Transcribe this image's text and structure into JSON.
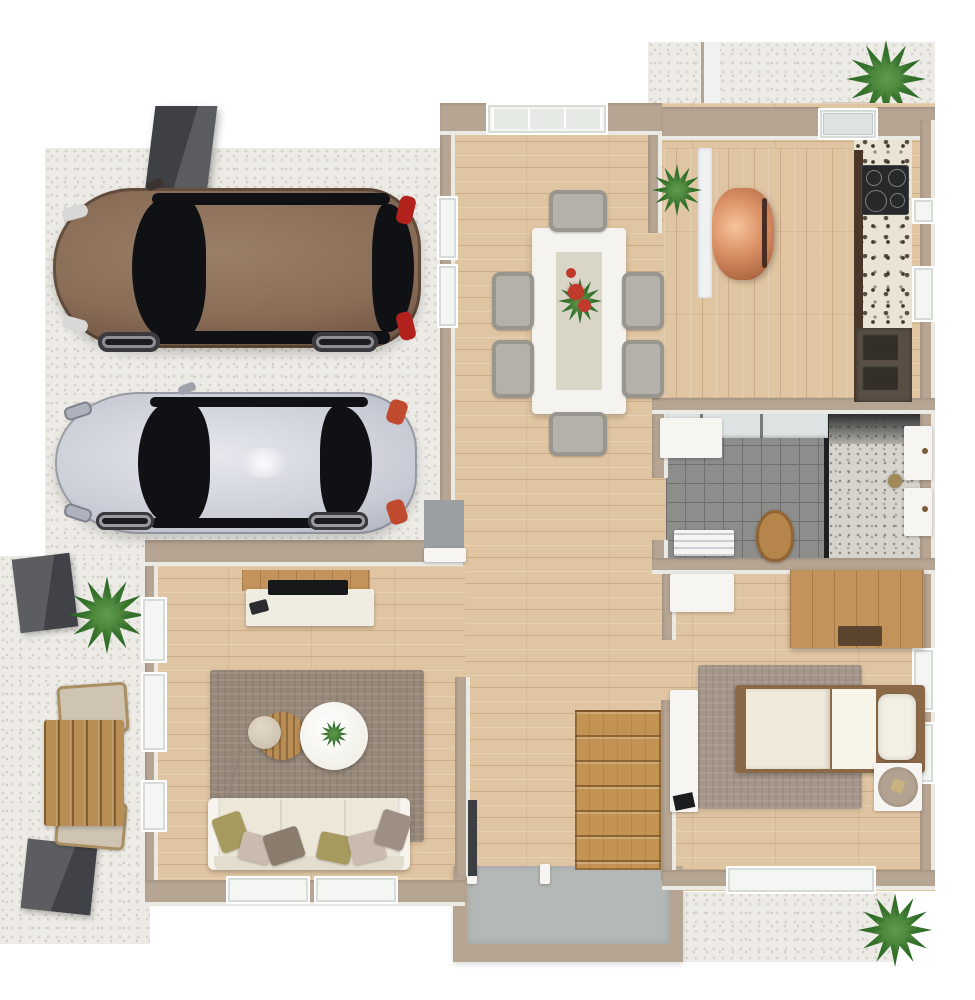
{
  "scene": {
    "description": "3D rendered top-down floor plan of a single-storey home with driveway, two parked cars, dining room, kitchen, bathroom, living room, bedroom, staircase, entry vestibule and patios. No text labels are rendered.",
    "view": "top-down isometric render"
  },
  "colors": {
    "wall": "#b7a593",
    "wall_face": "#f0f1f2",
    "wood": "#e0c5a2",
    "pavers": "#edebe6",
    "paver_dot": "#d8d4cc",
    "tile": "#8d8d8b",
    "tile_line": "#6f6f6d",
    "entry_floor": "#b4b8b6",
    "stairs": "#c39354",
    "granite_base": "#eae4d4",
    "granite_speck": "#413a32",
    "counter_wood": "#4a3628",
    "sink": "#584e44",
    "cooktop": "#26282a",
    "copper": "#d98d63",
    "plant": "#2f6d28",
    "plant_dark": "#1e4d1a",
    "cube": "#4b4d50",
    "outdoor_wood": "#b98e55",
    "chair_fabric": "#cfc4b2",
    "table_white": "#f4f3ef",
    "chair_gray": "#b3b1a9",
    "flower_red": "#c0392d",
    "rug_living": "#97897a",
    "rug_bedroom": "#a5968a",
    "sofa": "#ece7d8",
    "pillow_olive": "#a79a5e",
    "pillow_beige": "#c9bcae",
    "pillow_brown": "#8a7d6d",
    "pillow_gray": "#9d8f83",
    "oak": "#c2935a",
    "tv": "#17181a",
    "console_white": "#efece1",
    "bed_duvet": "#efead9",
    "bed_sheet": "#f7f4ea",
    "bed_frame": "#8a6848",
    "bedside_top": "#b2a291",
    "car_brown": "#8a6d57",
    "car_brown_dark": "#4a372b",
    "car_silver": "#c9ccd6",
    "car_glass": "#101114",
    "taillight": "#b3211c",
    "toilet_wood": "#b5854c",
    "door_dark": "#3c3f41",
    "mat_gray": "#9b9fa2",
    "shower_floor": "#d6d4cd"
  },
  "inventory": {
    "driveway": [
      "brown-suv",
      "silver-coupe",
      "chimney-block",
      "paver-surface"
    ],
    "dining_room": [
      "dining-table",
      "six-chairs",
      "red-flower-centerpiece",
      "corner-plant",
      "frosted-window"
    ],
    "kitchen": [
      "granite-counter",
      "cooktop",
      "double-sink",
      "copper-chair",
      "front-door",
      "doormat"
    ],
    "bathroom": [
      "gray-tile-floor",
      "walk-in-shower",
      "wooden-lid-toilet",
      "vanity",
      "radiator",
      "wall-fixtures"
    ],
    "living_room": [
      "tv-sideboard",
      "tv",
      "area-rug",
      "round-wood-table",
      "round-white-table",
      "arc-floor-lamp",
      "cream-sofa",
      "six-pillows",
      "windows"
    ],
    "bedroom": [
      "single-bed",
      "pillow",
      "area-rug",
      "oak-wardrobe-desk",
      "white-dresser",
      "wall-console",
      "bedside-table"
    ],
    "circulation": [
      "staircase",
      "entry-vestibule",
      "hallway"
    ],
    "patios": [
      "outdoor-table",
      "two-folding-chairs",
      "palm-plants",
      "gray-planter-cubes"
    ]
  }
}
